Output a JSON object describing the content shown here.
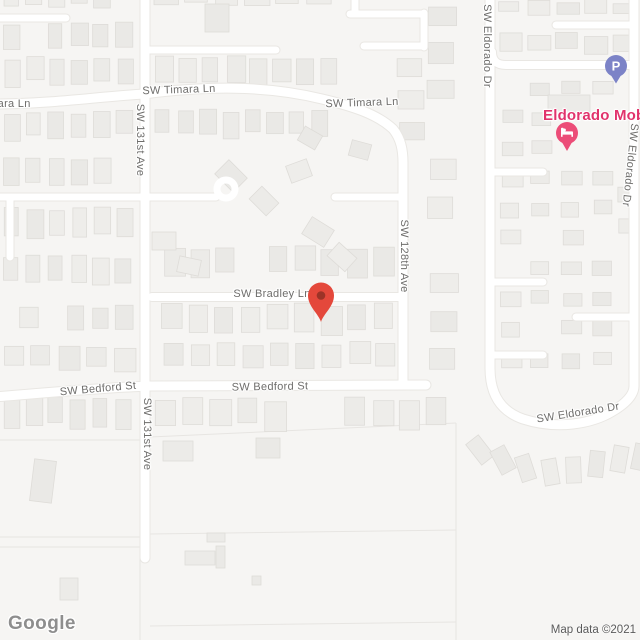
{
  "map": {
    "street_labels": [
      {
        "text": "SW Timara Ln",
        "x": -6,
        "y": 104,
        "rot": 0
      },
      {
        "text": "SW Timara Ln",
        "x": 179,
        "y": 90,
        "rot": -2
      },
      {
        "text": "SW Timara Ln",
        "x": 362,
        "y": 103,
        "rot": -2
      },
      {
        "text": "SW 131st Ave",
        "x": 140,
        "y": 140,
        "rot": 90
      },
      {
        "text": "SW 131st Ave",
        "x": 147,
        "y": 434,
        "rot": 90
      },
      {
        "text": "SW 128th Ave",
        "x": 404,
        "y": 256,
        "rot": 90
      },
      {
        "text": "SW Bradley Ln",
        "x": 272,
        "y": 294,
        "rot": 0
      },
      {
        "text": "SW Bedford St",
        "x": 98,
        "y": 389,
        "rot": -5
      },
      {
        "text": "SW Bedford St",
        "x": 270,
        "y": 387,
        "rot": -1
      },
      {
        "text": "SW Eldorado Dr",
        "x": 487,
        "y": 46,
        "rot": 90
      },
      {
        "text": "SW Eldorado Dr",
        "x": 630,
        "y": 165,
        "rot": 96
      },
      {
        "text": "SW Eldorado Dr",
        "x": 578,
        "y": 413,
        "rot": -9
      }
    ],
    "poi": {
      "name": "Eldorado Mobil",
      "label_color": "#e1336c",
      "x": 543,
      "y": 107
    },
    "markers": {
      "destination": {
        "x": 321,
        "y": 322,
        "color": "#e4483b",
        "dot_color": "#9c3327"
      },
      "parking": {
        "label": "P",
        "x": 616,
        "y": 66,
        "color": "#7c83c7"
      },
      "lodging": {
        "icon": "bed-icon",
        "x": 567,
        "y": 133,
        "color": "#ec4d78"
      }
    }
  },
  "attribution": {
    "logo": "Google",
    "map_data": "Map data ©2021"
  },
  "colors": {
    "background": "#f6f5f3",
    "road": "#ffffff",
    "building": "#ecebe8",
    "street_label": "#6e6d6b"
  }
}
